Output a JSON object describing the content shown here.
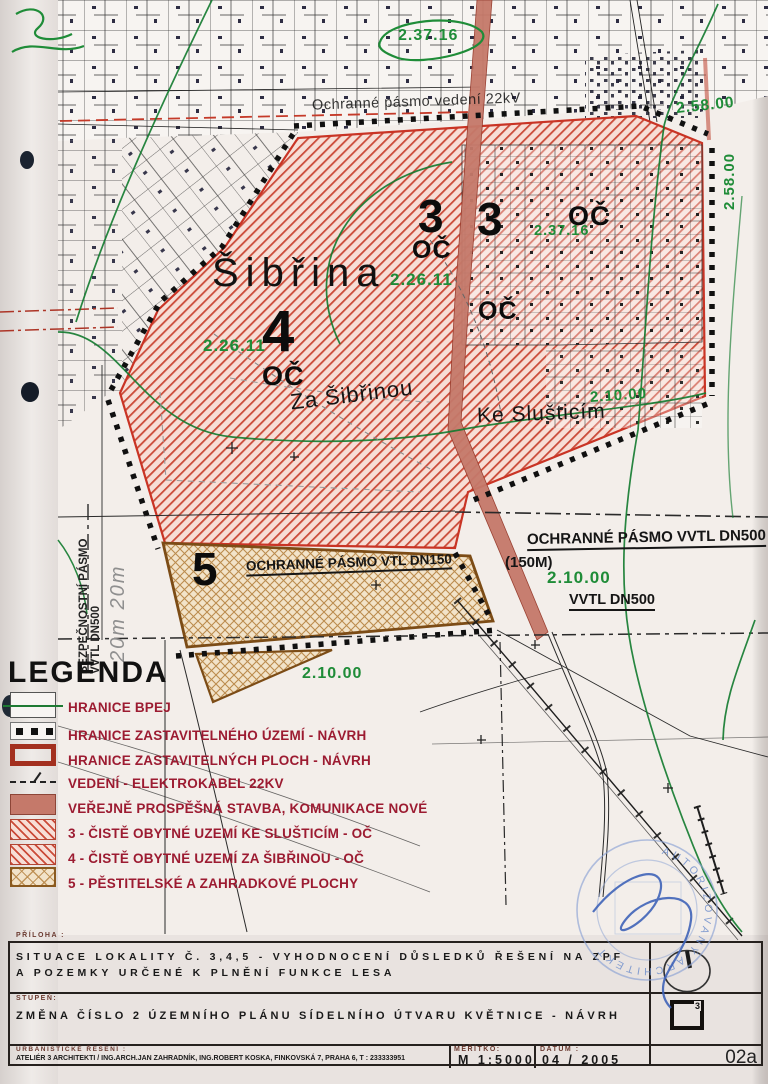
{
  "colors": {
    "paper": "#e9e3e0",
    "map_paper": "#f3eeea",
    "hatch_red": "#cb4b39",
    "hatch_bg": "#f7ded6",
    "zone5_stroke": "#bb8c4e",
    "zone5_bg": "#f2e3c9",
    "zone5_border": "#7c4c16",
    "road_salmon": "#c5796a",
    "boundary_red": "#c93425",
    "pen_green": "#1f8c38",
    "contour_green": "#117a2e",
    "legend_text": "#9c1b31",
    "stamp_blue": "#7190cc"
  },
  "map": {
    "streets": {
      "sibrina": "Šibřina",
      "za_sibrinou": "Za Šibřinou",
      "ke_slusticim": "Ke Slušticím"
    },
    "note_22kv": "Ochranné pásmo vedení 22kV",
    "zones": {
      "n3": "3",
      "n4": "4",
      "n5": "5",
      "oc": "OČ"
    },
    "bpej": {
      "b23716": "2.37.16",
      "b25800": "2.58.00",
      "b22611": "2.26.11",
      "b21000": "2.10.00"
    },
    "protection": {
      "op_vvtl_dn500": "OCHRANNÉ PÁSMO VVTL DN500",
      "op_vvtl_dn500_b": "(150M)",
      "vvtl_dn500": "VVTL DN500",
      "op_vtl_dn150": "OCHRANNÉ PÁSMO VTL DN150",
      "bezp_line1": "BEZPEČNOSTNÍ PÁSMO",
      "bezp_line2": "VVTL DN500",
      "dims": "20m 20m"
    }
  },
  "legend": {
    "title": "LEGENDA",
    "items": [
      {
        "label": "HRANICE BPEJ",
        "swatch": "bpej"
      },
      {
        "label": "HRANICE ZASTAVITELNÉHO ÚZEMÍ - NÁVRH",
        "swatch": "dots"
      },
      {
        "label": "HRANICE ZASTAVITELNÝCH PLOCH - NÁVRH",
        "swatch": "redout"
      },
      {
        "label": "VEDENÍ - ELEKTROKABEL 22KV",
        "swatch": "dash"
      },
      {
        "label": "VEŘEJNĚ PROSPĚŠNÁ STAVBA, KOMUNIKACE NOVÉ",
        "swatch": "solid"
      },
      {
        "label": "3 - ČISTĚ OBYTNÉ UZEMÍ KE SLUŠTICÍM - OČ",
        "swatch": "hatch"
      },
      {
        "label": "4 - ČISTĚ OBYTNÉ UZEMÍ ZA ŠIBŘINOU - OČ",
        "swatch": "hatch"
      },
      {
        "label": "5 - PĚSTITELSKÉ A ZAHRADKOVÉ PLOCHY",
        "swatch": "cross"
      }
    ]
  },
  "titleblock": {
    "priloha_label": "PŘÍLOHA :",
    "priloha_line1": "SITUACE LOKALITY Č. 3,4,5 - VYHODNOCENÍ DŮSLEDKŮ ŘEŠENÍ NA ZPF",
    "priloha_line2": "A POZEMKY URČENÉ K PLNĚNÍ FUNKCE LESA",
    "stupen_label": "STUPEŇ:",
    "stupen_value": "ZMĚNA ČÍSLO 2 ÚZEMNÍHO PLÁNU SÍDELNÍHO ÚTVARU KVĚTNICE - NÁVRH",
    "urb_label": "URBANISTICKÉ ŘEŠENÍ :",
    "urb_value": "ATELIÉR 3 ARCHITEKTI / ING.ARCH.JAN ZAHRADNÍK, ING.ROBERT KOSKA, FINKOVSKÁ 7, PRAHA 6, T : 233333951",
    "meritko_label": "MĚŘÍTKO:",
    "meritko_value": "M 1:5000",
    "datum_label": "DATUM :",
    "datum_value": "04 / 2005",
    "sheet_no": "02a",
    "loc_icon_label": "3"
  },
  "stamp": {
    "ring_text": "AUTORIZOVANÝ ARCHITEKT"
  }
}
